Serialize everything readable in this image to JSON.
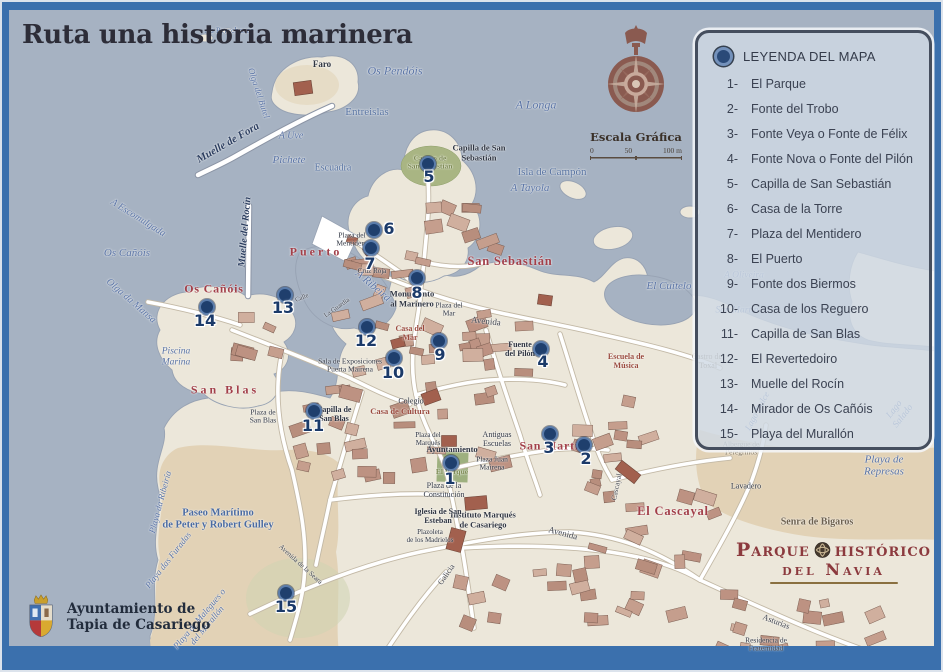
{
  "title": "Ruta una historia marinera",
  "compass": {
    "scale_title": "Escala Gráfica",
    "scale_ticks": [
      "0",
      "50",
      "100 m"
    ]
  },
  "legend": {
    "title": "LEYENDA DEL MAPA",
    "items": [
      {
        "num": "1-",
        "label": "El Parque"
      },
      {
        "num": "2-",
        "label": "Fonte del Trobo"
      },
      {
        "num": "3-",
        "label": "Fonte Veya o Fonte de Félix"
      },
      {
        "num": "4-",
        "label": "Fonte Nova o Fonte del Pilón"
      },
      {
        "num": "5-",
        "label": "Capilla de San Sebastián"
      },
      {
        "num": "6-",
        "label": "Casa de la Torre"
      },
      {
        "num": "7-",
        "label": "Plaza del Mentidero"
      },
      {
        "num": "8-",
        "label": "El Puerto"
      },
      {
        "num": "9-",
        "label": "Fonte dos Biermos"
      },
      {
        "num": "10-",
        "label": "Casa de los Reguero"
      },
      {
        "num": "11-",
        "label": "Capilla de San Blas"
      },
      {
        "num": "12-",
        "label": "El Revertedoiro"
      },
      {
        "num": "13-",
        "label": "Muelle del Rocín"
      },
      {
        "num": "14-",
        "label": "Mirador de Os Cañóis"
      },
      {
        "num": "15-",
        "label": "Playa del Murallón"
      }
    ]
  },
  "municipality": {
    "line1": "Ayuntamiento de",
    "line2": "Tapia de Casariego"
  },
  "park_logo": {
    "word1": "Parque",
    "word2": "histórico",
    "line2": "del Navia"
  },
  "markers": {
    "dots": [
      {
        "n": "1",
        "x": 451,
        "y": 463
      },
      {
        "n": "2",
        "x": 584,
        "y": 445
      },
      {
        "n": "3",
        "x": 550,
        "y": 434
      },
      {
        "n": "4",
        "x": 541,
        "y": 349
      },
      {
        "n": "5",
        "x": 428,
        "y": 164
      },
      {
        "n": "6",
        "x": 374,
        "y": 230
      },
      {
        "n": "7",
        "x": 371,
        "y": 248
      },
      {
        "n": "8",
        "x": 417,
        "y": 278
      },
      {
        "n": "9",
        "x": 439,
        "y": 341
      },
      {
        "n": "10",
        "x": 394,
        "y": 358
      },
      {
        "n": "11",
        "x": 314,
        "y": 411
      },
      {
        "n": "12",
        "x": 367,
        "y": 327
      },
      {
        "n": "13",
        "x": 285,
        "y": 295
      },
      {
        "n": "14",
        "x": 207,
        "y": 307
      },
      {
        "n": "15",
        "x": 286,
        "y": 593
      }
    ],
    "numbers": [
      {
        "t": "1",
        "x": 450,
        "y": 479
      },
      {
        "t": "2",
        "x": 586,
        "y": 459
      },
      {
        "t": "3",
        "x": 549,
        "y": 448
      },
      {
        "t": "4",
        "x": 543,
        "y": 362
      },
      {
        "t": "5",
        "x": 429,
        "y": 177
      },
      {
        "t": "6",
        "x": 389,
        "y": 229
      },
      {
        "t": "7",
        "x": 370,
        "y": 264
      },
      {
        "t": "8",
        "x": 417,
        "y": 293
      },
      {
        "t": "9",
        "x": 440,
        "y": 355
      },
      {
        "t": "10",
        "x": 393,
        "y": 373
      },
      {
        "t": "11",
        "x": 313,
        "y": 426
      },
      {
        "t": "12",
        "x": 366,
        "y": 341
      },
      {
        "t": "13",
        "x": 283,
        "y": 308
      },
      {
        "t": "14",
        "x": 205,
        "y": 321
      },
      {
        "t": "15",
        "x": 286,
        "y": 607
      }
    ]
  },
  "map_labels": [
    {
      "t": "As Percebosas",
      "x": 229,
      "y": 31,
      "cls": "water-up",
      "fs": 8.5
    },
    {
      "t": "Os Pendóis",
      "x": 395,
      "y": 71,
      "cls": "water",
      "fs": 12
    },
    {
      "t": "A Longa",
      "x": 536,
      "y": 105,
      "cls": "water",
      "fs": 12
    },
    {
      "t": "Entreislas",
      "x": 367,
      "y": 112,
      "cls": "water-up",
      "fs": 11
    },
    {
      "t": "A Uve",
      "x": 291,
      "y": 136,
      "cls": "water",
      "fs": 10
    },
    {
      "t": "Pichete",
      "x": 289,
      "y": 160,
      "cls": "water",
      "fs": 11
    },
    {
      "t": "Escuadra",
      "x": 333,
      "y": 168,
      "cls": "water-up",
      "fs": 10
    },
    {
      "t": "Isla de Campón",
      "x": 552,
      "y": 172,
      "cls": "water-up",
      "fs": 11
    },
    {
      "t": "A Tayola",
      "x": 530,
      "y": 188,
      "cls": "water",
      "fs": 11
    },
    {
      "t": "A Escomulgada",
      "x": 138,
      "y": 218,
      "cls": "water",
      "fs": 10,
      "rot": 32
    },
    {
      "t": "Os Cañóis",
      "x": 127,
      "y": 253,
      "cls": "water",
      "fs": 11
    },
    {
      "t": "Olga da Mansa",
      "x": 131,
      "y": 301,
      "cls": "water",
      "fs": 10,
      "rot": 41
    },
    {
      "t": "A Ribeira",
      "x": 373,
      "y": 286,
      "cls": "water",
      "fs": 11,
      "rot": 40
    },
    {
      "t": "El Cuitelo",
      "x": 669,
      "y": 286,
      "cls": "water",
      "fs": 11
    },
    {
      "t": "A Oliveira",
      "x": 744,
      "y": 276,
      "cls": "water",
      "fs": 9.5
    },
    {
      "t": "San Martín",
      "x": 737,
      "y": 311,
      "cls": "water",
      "fs": 9.5
    },
    {
      "t": "Lago Dulce",
      "x": 757,
      "y": 411,
      "cls": "water",
      "fs": 9,
      "rot": -62
    },
    {
      "t": "Lago Salado",
      "x": 899,
      "y": 413,
      "cls": "water",
      "fs": 9.5,
      "rot": -52
    },
    {
      "t": "Playa de Represas",
      "x": 884,
      "y": 466,
      "cls": "water",
      "fs": 11
    },
    {
      "t": "Playa da Ribeiría",
      "x": 160,
      "y": 502,
      "cls": "water",
      "fs": 9,
      "rot": -75
    },
    {
      "t": "Playa das Furadas",
      "x": 168,
      "y": 560,
      "cls": "water",
      "fs": 9,
      "rot": -52
    },
    {
      "t": "Playa de Malegues o\ndel Murallón",
      "x": 203,
      "y": 622,
      "cls": "water",
      "fs": 9,
      "rot": -50
    },
    {
      "t": "Piscina\nMarina",
      "x": 176,
      "y": 357,
      "cls": "water",
      "fs": 9.5
    },
    {
      "t": "Olga del Butel",
      "x": 259,
      "y": 93,
      "cls": "water",
      "fs": 9,
      "rot": 72
    },
    {
      "t": "Paseo Marítimo\nde Peter y Robert Gulley",
      "x": 218,
      "y": 519,
      "cls": "water-b",
      "fs": 10.5
    },
    {
      "t": "Muelle de Fora",
      "x": 228,
      "y": 143,
      "cls": "navy-it",
      "fs": 11,
      "rot": -30
    },
    {
      "t": "Muelle del Rocín",
      "x": 245,
      "y": 232,
      "cls": "navy-it",
      "fs": 10,
      "rot": -85
    },
    {
      "t": "Puerto",
      "x": 316,
      "y": 252,
      "cls": "red red-sp",
      "fs": 12
    },
    {
      "t": "San Sebastián",
      "x": 510,
      "y": 261,
      "cls": "red",
      "fs": 12.5
    },
    {
      "t": "Os Cañóis",
      "x": 214,
      "y": 289,
      "cls": "red",
      "fs": 12
    },
    {
      "t": "San Blas",
      "x": 225,
      "y": 390,
      "cls": "red red-sp",
      "fs": 12
    },
    {
      "t": "San Martín",
      "x": 553,
      "y": 446,
      "cls": "red",
      "fs": 12
    },
    {
      "t": "El Cascayal",
      "x": 673,
      "y": 511,
      "cls": "red",
      "fs": 12.5
    },
    {
      "t": "Escuela de\nMúsica",
      "x": 626,
      "y": 362,
      "cls": "redbrown",
      "fs": 8
    },
    {
      "t": "Faro",
      "x": 322,
      "y": 64,
      "cls": "dark-b",
      "fs": 9
    },
    {
      "t": "Capilla de San\nSebastián",
      "x": 479,
      "y": 153,
      "cls": "dark-b",
      "fs": 8.5
    },
    {
      "t": "Campo de\nSan Sebastián",
      "x": 430,
      "y": 163,
      "cls": "olive",
      "fs": 7.5
    },
    {
      "t": "Plaza del\nMentidero",
      "x": 352,
      "y": 240,
      "cls": "dark",
      "fs": 7.5
    },
    {
      "t": "Cruz Roja",
      "x": 372,
      "y": 272,
      "cls": "dark",
      "fs": 7
    },
    {
      "t": "Monumento\nal Marinero",
      "x": 412,
      "y": 299,
      "cls": "dark-b",
      "fs": 8.5
    },
    {
      "t": "Plaza del\nMar",
      "x": 449,
      "y": 310,
      "cls": "dark",
      "fs": 7.5
    },
    {
      "t": "Fuente\ndel Pilón",
      "x": 520,
      "y": 350,
      "cls": "dark-b",
      "fs": 8
    },
    {
      "t": "Casa del\nMar",
      "x": 410,
      "y": 334,
      "cls": "redbrown",
      "fs": 8
    },
    {
      "t": "Sala de Exposiciones\nPuerta Mairena",
      "x": 350,
      "y": 366,
      "cls": "dark",
      "fs": 7.5
    },
    {
      "t": "Colegio",
      "x": 411,
      "y": 402,
      "cls": "dark",
      "fs": 8
    },
    {
      "t": "Casa de Cultura",
      "x": 400,
      "y": 412,
      "cls": "redbrown",
      "fs": 8.5
    },
    {
      "t": "Capilla de\nSan Blas",
      "x": 334,
      "y": 415,
      "cls": "dark-b",
      "fs": 8
    },
    {
      "t": "Plaza de\nSan Blas",
      "x": 263,
      "y": 417,
      "cls": "dark",
      "fs": 7.5
    },
    {
      "t": "Plaza del\nMarqués",
      "x": 428,
      "y": 440,
      "cls": "dark",
      "fs": 7
    },
    {
      "t": "Ayuntamiento",
      "x": 452,
      "y": 450,
      "cls": "dark-b",
      "fs": 8.5
    },
    {
      "t": "Antiguas\nEscuelas",
      "x": 497,
      "y": 440,
      "cls": "dark",
      "fs": 8
    },
    {
      "t": "Plaza Juan\nMairena",
      "x": 492,
      "y": 464,
      "cls": "dark",
      "fs": 7.5
    },
    {
      "t": "El Parque",
      "x": 452,
      "y": 472,
      "cls": "olive",
      "fs": 7.5
    },
    {
      "t": "Plaza de la\nConstitución",
      "x": 444,
      "y": 491,
      "cls": "dark",
      "fs": 8
    },
    {
      "t": "Instituto Marqués\nde Casariego",
      "x": 483,
      "y": 520,
      "cls": "dark-b",
      "fs": 8.5
    },
    {
      "t": "Iglesia de San\nEsteban",
      "x": 438,
      "y": 517,
      "cls": "dark-b",
      "fs": 8
    },
    {
      "t": "Plazoleta\nde los Madrielos",
      "x": 430,
      "y": 537,
      "cls": "dark",
      "fs": 7
    },
    {
      "t": "Castro del\nToxal",
      "x": 708,
      "y": 362,
      "cls": "brown",
      "fs": 8
    },
    {
      "t": "Albergue de\nPeregrinos",
      "x": 741,
      "y": 449,
      "cls": "brown",
      "fs": 7.5
    },
    {
      "t": "Lavadero",
      "x": 746,
      "y": 487,
      "cls": "dark",
      "fs": 8
    },
    {
      "t": "Senra de Bigaros",
      "x": 817,
      "y": 522,
      "cls": "brown-b",
      "fs": 10
    },
    {
      "t": "Residencia de\nFraternidad",
      "x": 766,
      "y": 645,
      "cls": "dark",
      "fs": 7.5
    },
    {
      "t": "Avenida",
      "x": 486,
      "y": 321,
      "cls": "street",
      "fs": 9,
      "rot": 6
    },
    {
      "t": "Avenida",
      "x": 563,
      "y": 533,
      "cls": "street",
      "fs": 9,
      "rot": 15
    },
    {
      "t": "Asturias",
      "x": 776,
      "y": 622,
      "cls": "street",
      "fs": 8.5,
      "rot": 21
    },
    {
      "t": "Galicia",
      "x": 447,
      "y": 575,
      "cls": "street",
      "fs": 8,
      "rot": -55
    },
    {
      "t": "Avenida de la Seara",
      "x": 300,
      "y": 565,
      "cls": "street",
      "fs": 7,
      "rot": 42
    },
    {
      "t": "Cascayal",
      "x": 617,
      "y": 487,
      "cls": "street",
      "fs": 7.5,
      "rot": -78
    },
    {
      "t": "Calle",
      "x": 302,
      "y": 298,
      "cls": "street",
      "fs": 6.5,
      "rot": -22
    },
    {
      "t": "La Guardia",
      "x": 337,
      "y": 308,
      "cls": "street",
      "fs": 6.5,
      "rot": -35
    }
  ],
  "colors": {
    "water": "#a6b2c2",
    "land": "#ece7da",
    "sand": "#e2d2b6",
    "building": "#c59e8d",
    "building_dark": "#a2604e",
    "marker": "#1f3f6d",
    "frame": "#3b70ad",
    "red_label": "#a23f49",
    "legend_bg": "rgba(208,217,228,0.82)"
  }
}
